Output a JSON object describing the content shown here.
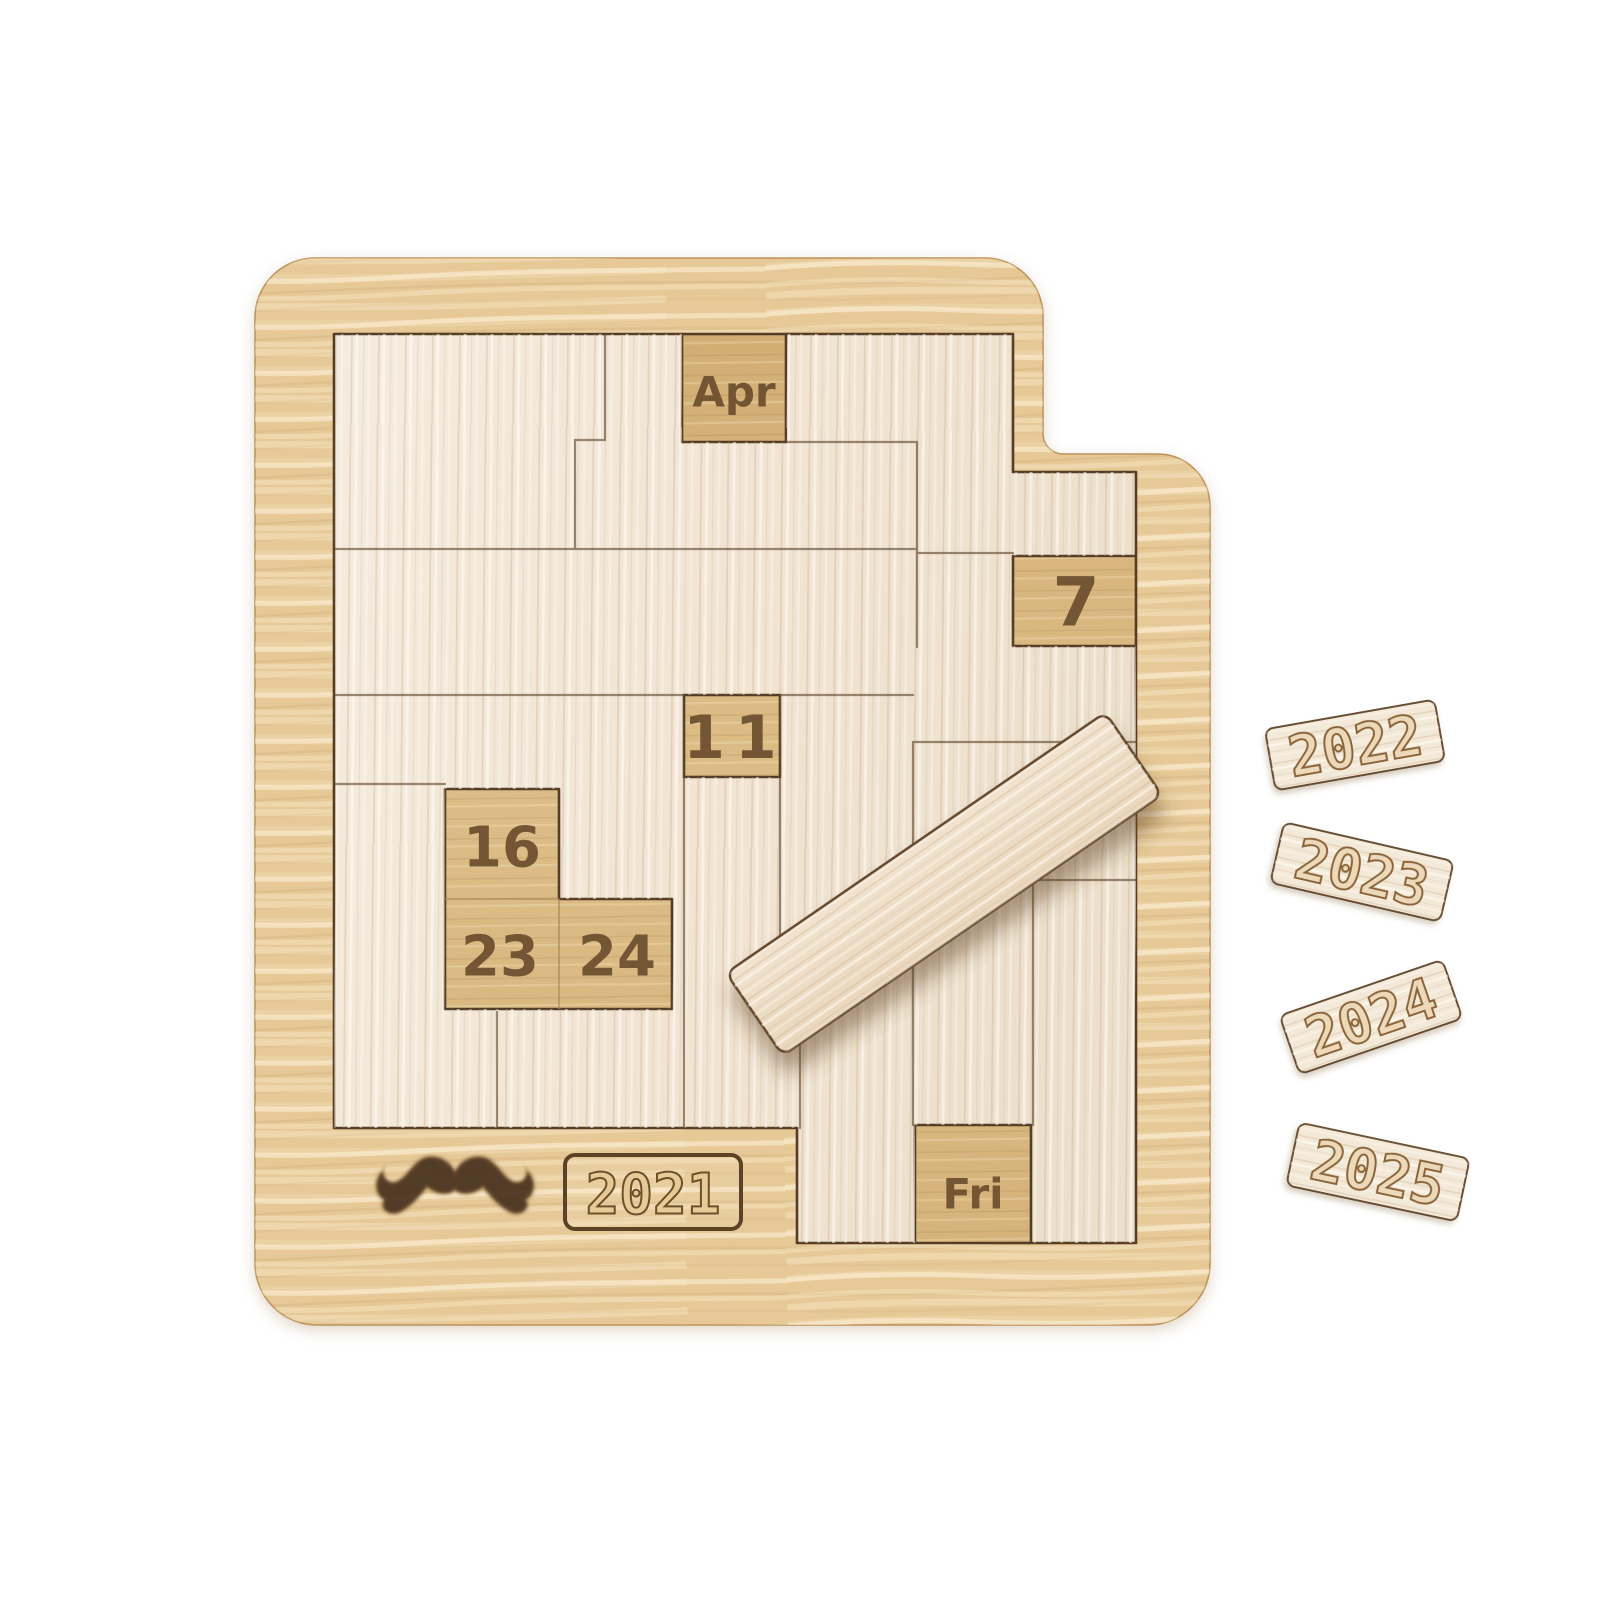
{
  "product": {
    "kind": "wooden-daily-calendar-puzzle-photo",
    "board": {
      "engravings": {
        "month": "Apr",
        "day_7": "7",
        "day_11": "11",
        "day_16": "16",
        "day_23": "23",
        "day_24": "24",
        "weekday": "Fri",
        "year_plate": "2021"
      },
      "icons": {
        "mustache": "handlebar-mustache"
      }
    },
    "year_tiles": [
      {
        "label": "2022"
      },
      {
        "label": "2023"
      },
      {
        "label": "2024"
      },
      {
        "label": "2025"
      }
    ],
    "colors": {
      "background": "#ffffff",
      "frame_wood": "#e6c997",
      "frame_wood_light": "#f2dfb6",
      "recess_floor": "#d8b77e",
      "piece_wood": "#f3e8da",
      "piece_grain": "#d9c0a4",
      "outline_dark": "#543d24",
      "engraving": "#6f5130"
    }
  }
}
